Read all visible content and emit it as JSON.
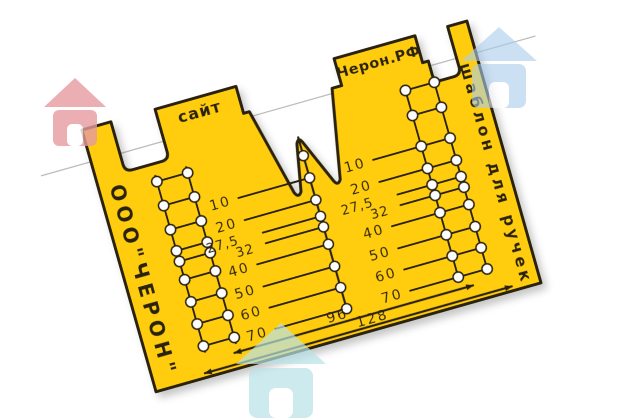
{
  "scene": {
    "background": "#ffffff",
    "backing_sheet_edge_color": "#bdbdbd"
  },
  "plate": {
    "material_color": "#FFCD0E",
    "engraving_color": "#2a2208",
    "hole_color": "#fdfdfd",
    "tabs": [
      {
        "label": "сайт"
      },
      {
        "label": "Черон.РФ"
      }
    ],
    "left_edge_text": "ООО\"ЧЕРОН\"",
    "right_edge_text": "шаблон для ручек",
    "left_scale": [
      "10",
      "20",
      "27,5",
      "32",
      "40",
      "50",
      "60",
      "70"
    ],
    "right_scale": [
      "10",
      "20",
      "27,5",
      "32",
      "40",
      "50",
      "60",
      "70"
    ],
    "bottom_spans": [
      {
        "label": "96"
      },
      {
        "label": "128"
      }
    ]
  },
  "watermarks": [
    {
      "icon": "house-icon",
      "color": "#e59ba1"
    },
    {
      "icon": "house-icon",
      "color": "#a9cdec"
    },
    {
      "icon": "house-icon",
      "color": "#b8e3e7"
    }
  ]
}
